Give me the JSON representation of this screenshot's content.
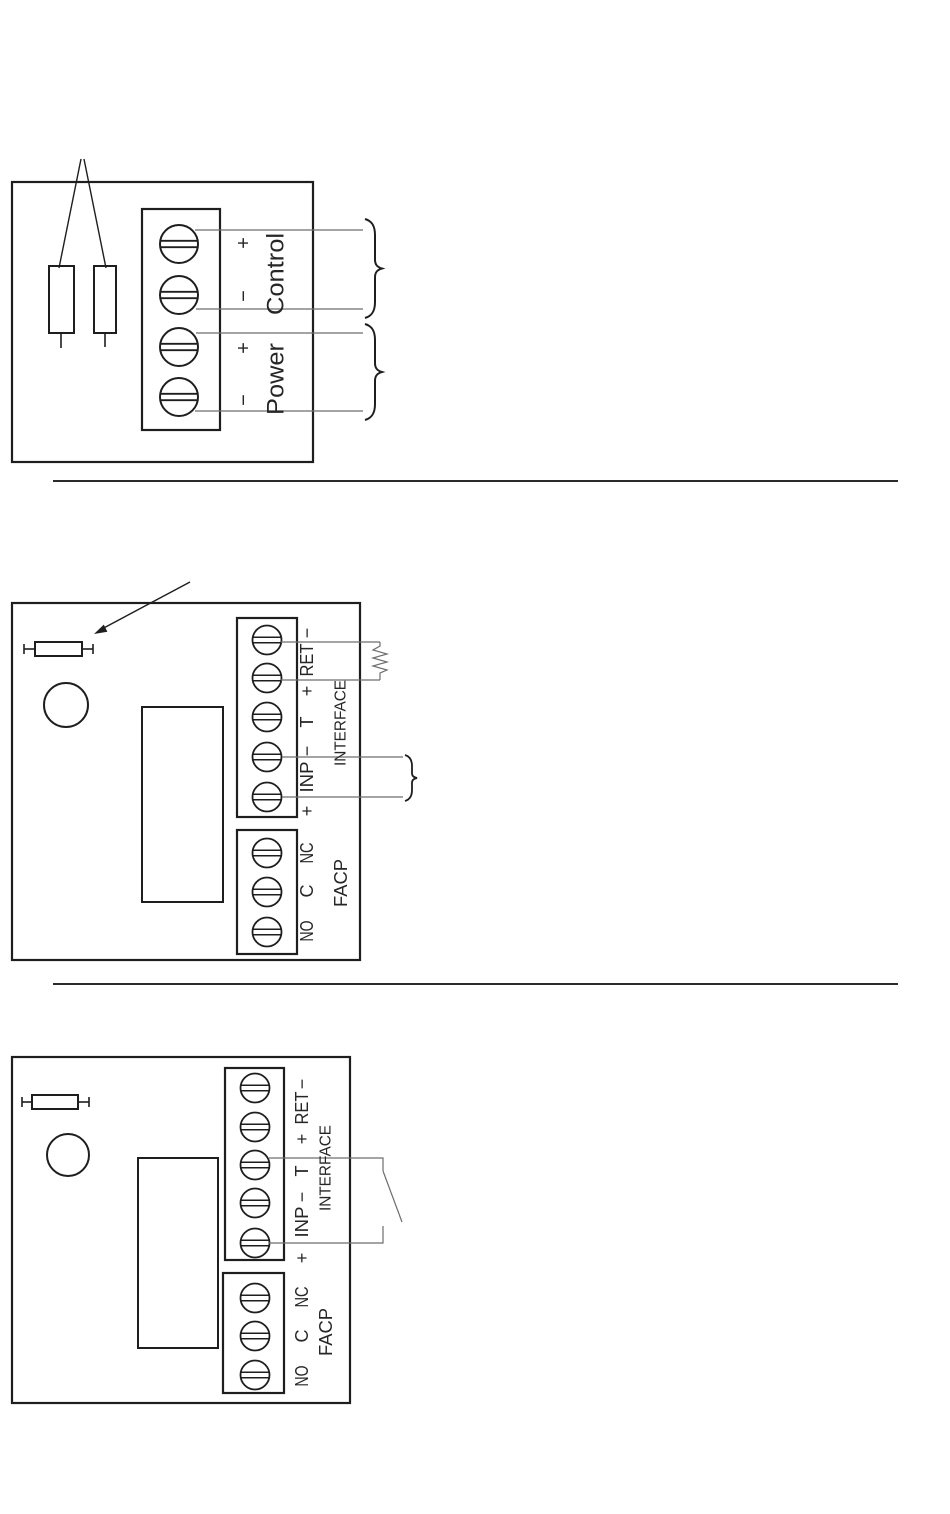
{
  "document": {
    "type": "wiring-diagram-page",
    "colors": {
      "ink": "#1e1e1e",
      "wire": "#6e6e6e",
      "text": "#262626",
      "background": "#ffffff"
    }
  },
  "fig1": {
    "description": "control-power-terminal-block-with-fuses",
    "plus": "+",
    "minus": "−",
    "control": "Control",
    "power": "Power"
  },
  "fig2": {
    "description": "interface-facp-terminals-with-eol-resistor",
    "minus": "−",
    "ret": "RET",
    "plus": "+",
    "t": "T",
    "inp": "INP",
    "interface": "INTERFACE",
    "nc": "NC",
    "c": "C",
    "no": "NO",
    "facp": "FACP"
  },
  "fig3": {
    "description": "interface-facp-terminals-with-switch-contact",
    "minus": "−",
    "ret": "RET",
    "plus": "+",
    "t": "T",
    "inp": "INP",
    "interface": "INTERFACE",
    "nc": "NC",
    "c": "C",
    "no": "NO",
    "facp": "FACP"
  }
}
